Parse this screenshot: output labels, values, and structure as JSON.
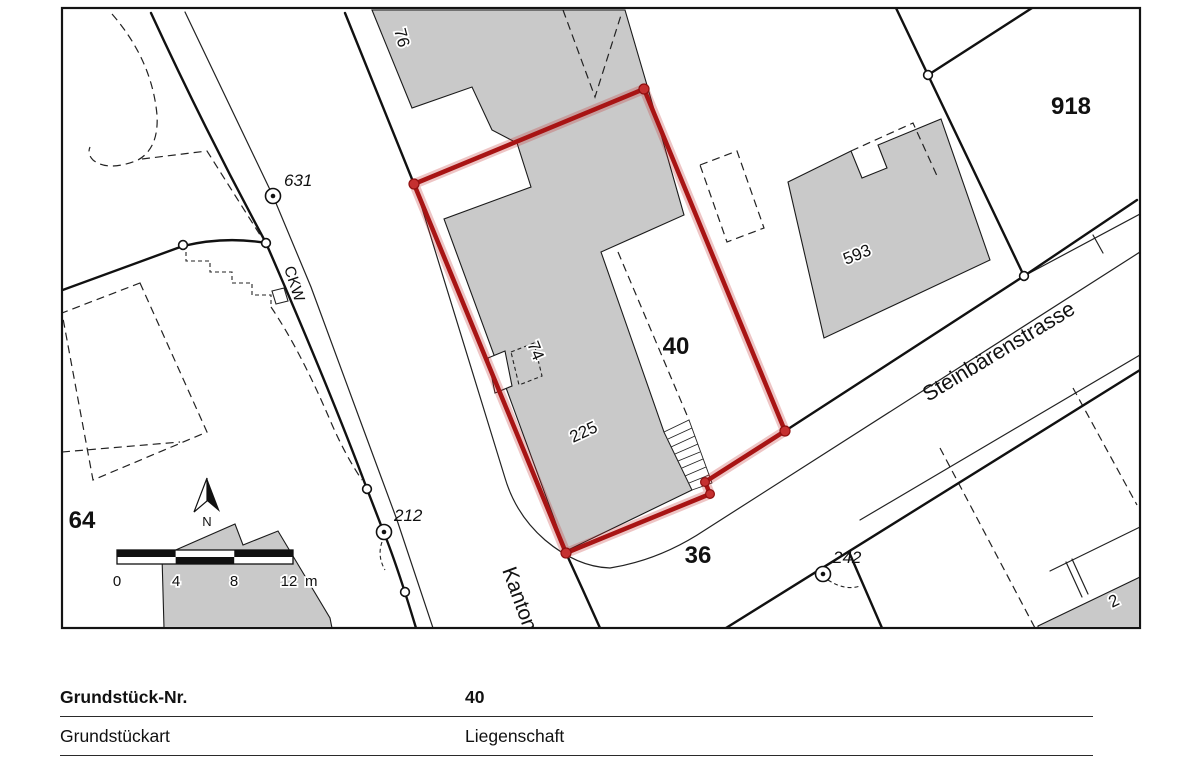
{
  "map_labels": {
    "parcels": {
      "p64": "64",
      "p918": "918",
      "p40": "40",
      "p36": "36"
    },
    "buildings": {
      "b76": "76",
      "b74": "74",
      "b225": "225",
      "b593": "593",
      "b2": "2"
    },
    "points": {
      "pt631": "631",
      "pt212": "212",
      "pt242": "242"
    },
    "streets": {
      "ckw": "CKW",
      "kantonsstrasse": "Kantonsstrasse",
      "steinbaerenstrasse": "Steinbärenstrasse"
    },
    "scale_bar": {
      "t0": "0",
      "t4": "4",
      "t8": "8",
      "t12": "12",
      "unit": "m"
    },
    "north": "N"
  },
  "table": {
    "rows": [
      {
        "label": "Grundstück-Nr.",
        "value": "40"
      },
      {
        "label": "Grundstückart",
        "value": "Liegenschaft"
      }
    ]
  },
  "colors": {
    "highlight": "#a81414",
    "building": "#c9c9c9"
  }
}
